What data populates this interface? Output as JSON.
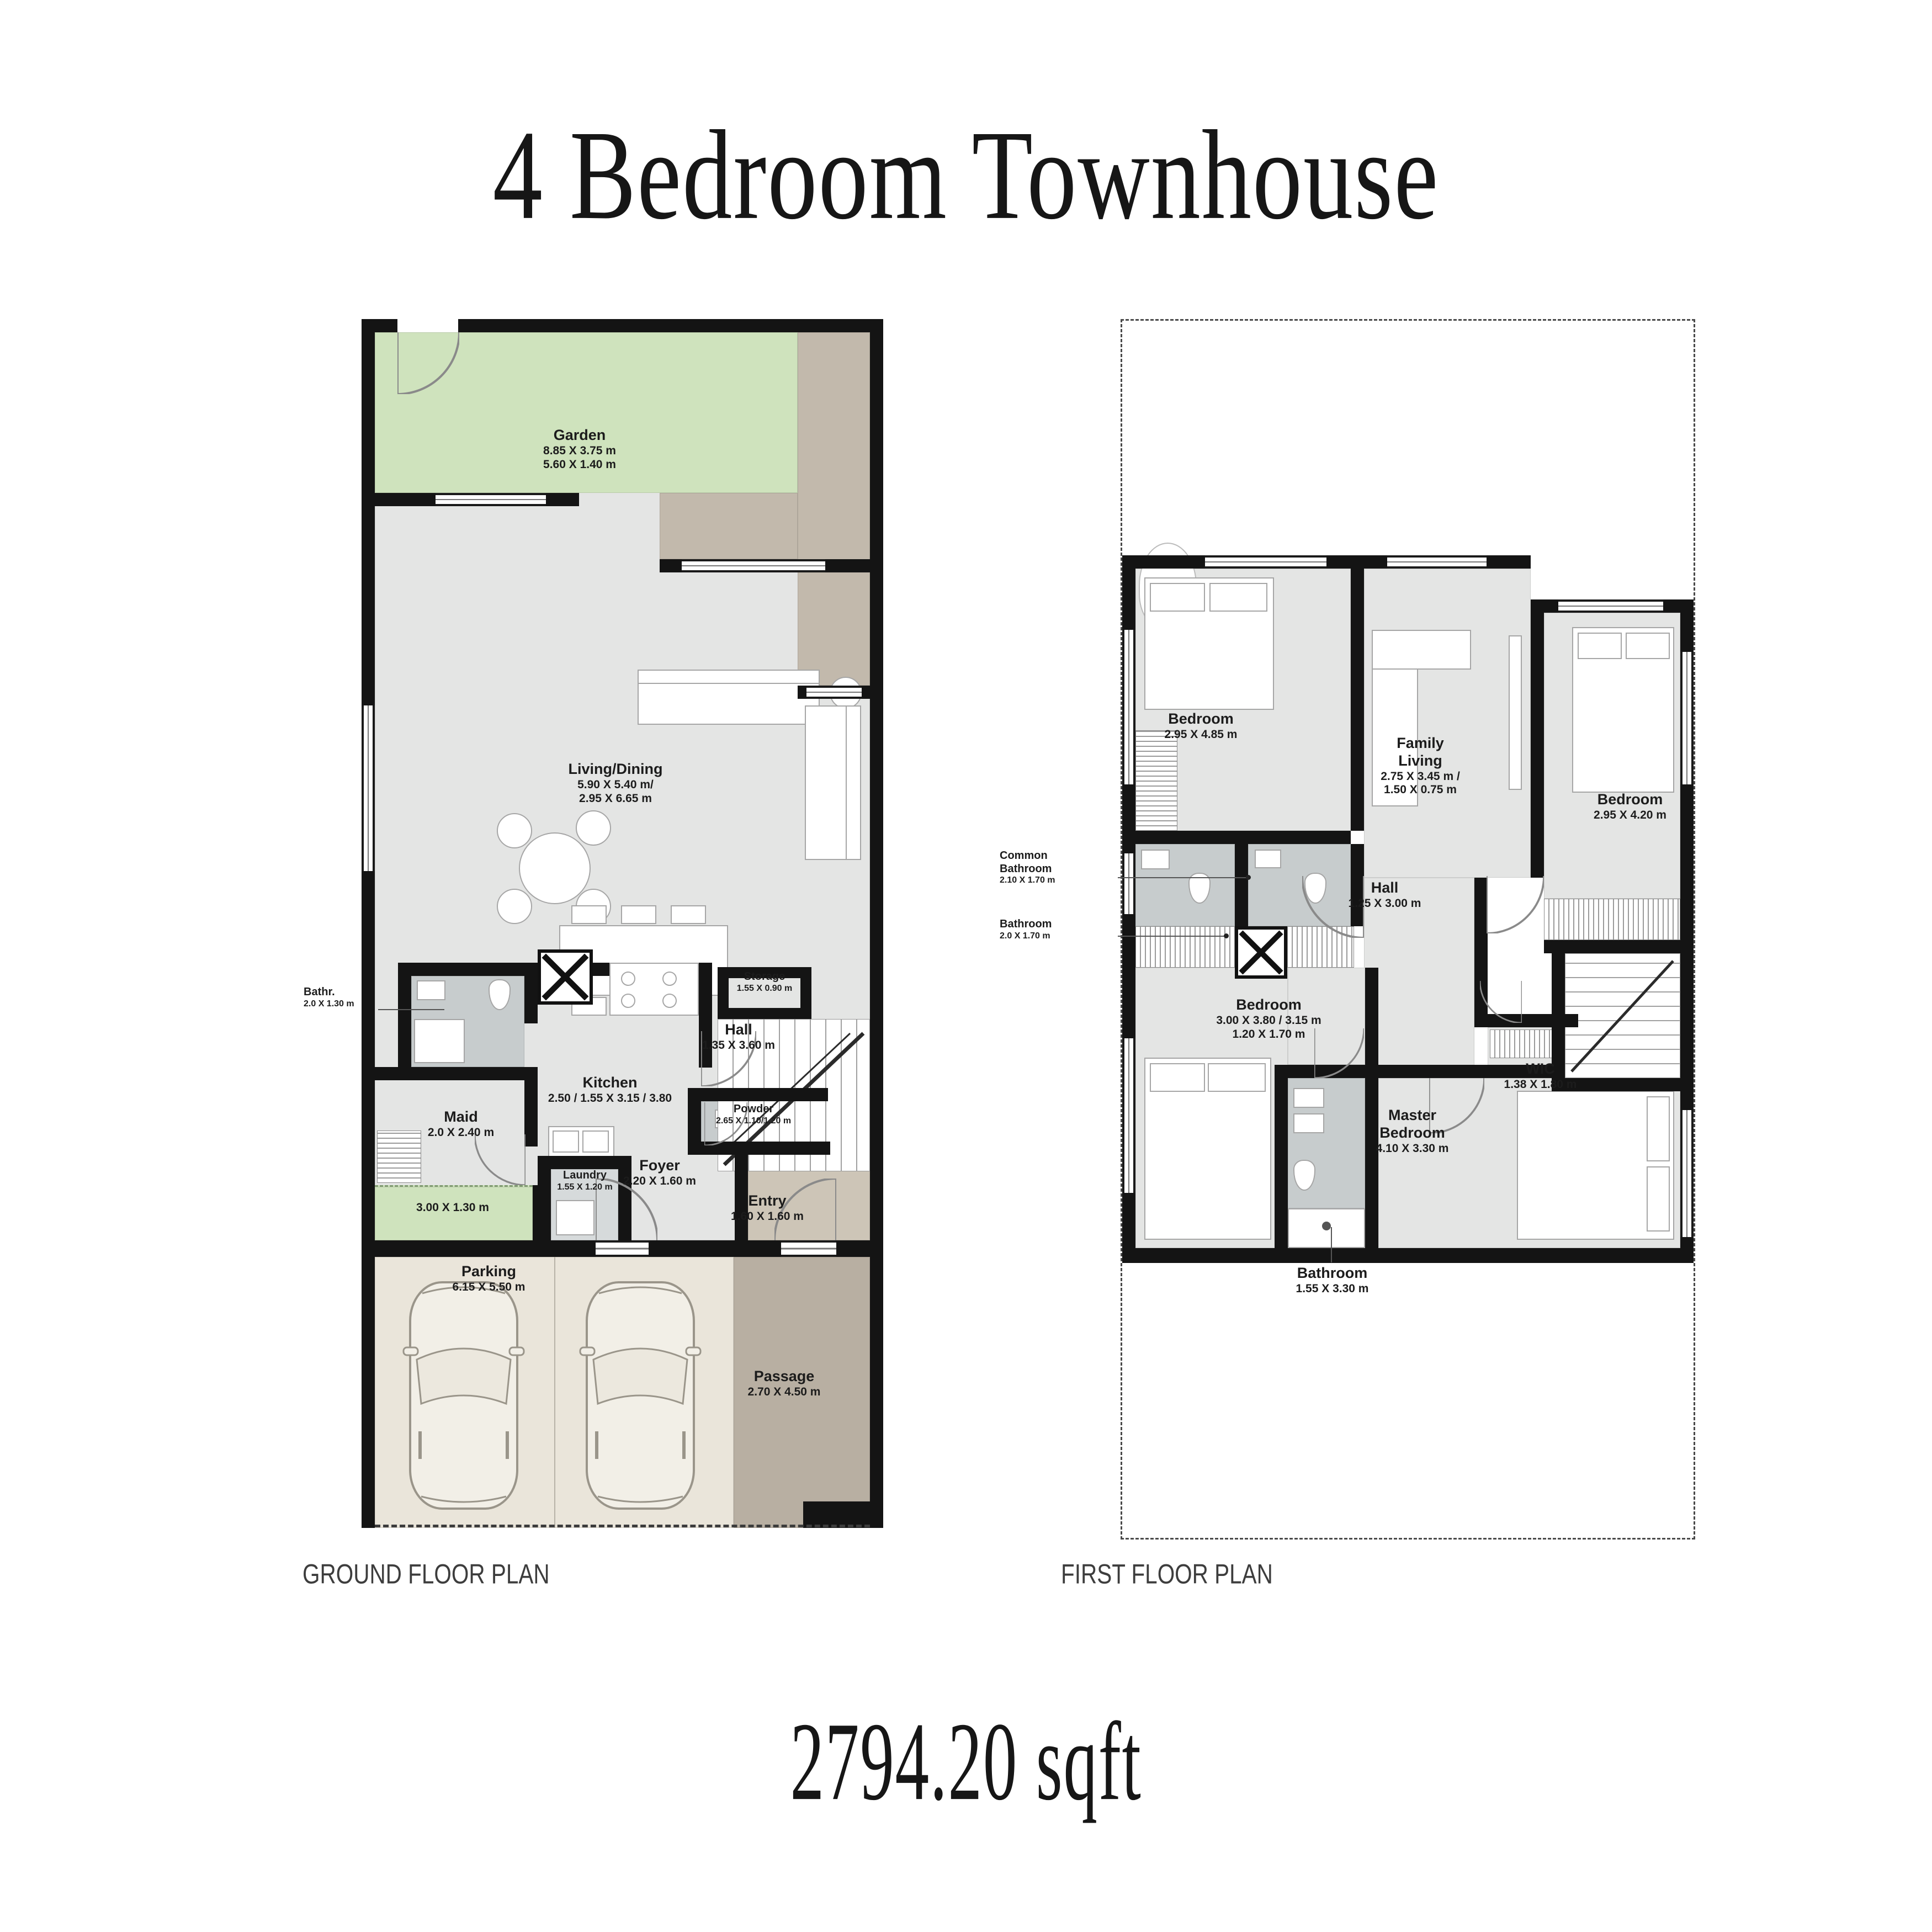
{
  "title": "4 Bedroom Townhouse",
  "area": "2794.20 sqft",
  "plans": {
    "ground": {
      "label": "GROUND FLOOR PLAN",
      "rooms": {
        "garden": {
          "name": "Garden",
          "dim1": "8.85 X 3.75 m",
          "dim2": "5.60 X 1.40 m"
        },
        "living_dining": {
          "name": "Living/Dining",
          "dim1": "5.90 X 5.40 m/",
          "dim2": "2.95 X 6.65 m"
        },
        "bathr": {
          "name": "Bathr.",
          "dim1": "2.0 X 1.30 m"
        },
        "kitchen": {
          "name": "Kitchen",
          "dim1": "2.50 / 1.55 X 3.15 / 3.80"
        },
        "hall": {
          "name": "Hall",
          "dim1": "1.35 X 3.60 m"
        },
        "maid": {
          "name": "Maid",
          "dim1": "2.0 X 2.40 m"
        },
        "storage": {
          "name": "Storage",
          "dim1": "1.55 X 0.90 m"
        },
        "powder": {
          "name": "Powder",
          "dim1": "2.65 X 1.10/1.20 m"
        },
        "foyer": {
          "name": "Foyer",
          "dim1": "2.20 X 1.60 m"
        },
        "laundry": {
          "name": "Laundry",
          "dim1": "1.55 X 1.20 m"
        },
        "entry": {
          "name": "Entry",
          "dim1": "1.60 X 1.60 m"
        },
        "parking": {
          "name": "Parking",
          "dim1": "6.15 X 5.50 m"
        },
        "passage": {
          "name": "Passage",
          "dim1": "2.70 X 4.50 m"
        },
        "side_yard": {
          "dim1": "3.00 X 1.30 m"
        }
      }
    },
    "first": {
      "label": "FIRST FLOOR PLAN",
      "rooms": {
        "bedroom_1": {
          "name": "Bedroom",
          "dim1": "2.95 X 4.85 m"
        },
        "family_living": {
          "name": "Family Living",
          "dim1": "2.75 X 3.45 m /",
          "dim2": "1.50 X 0.75 m"
        },
        "bedroom_2": {
          "name": "Bedroom",
          "dim1": "2.95 X 4.20 m"
        },
        "common_bathroom": {
          "name": "Common Bathroom",
          "dim1": "2.10 X 1.70 m"
        },
        "bathroom_1": {
          "name": "Bathroom",
          "dim1": "2.0 X 1.70 m"
        },
        "hall": {
          "name": "Hall",
          "dim1": "1.25 X 3.00 m"
        },
        "bedroom_3": {
          "name": "Bedroom",
          "dim1": "3.00 X 3.80 / 3.15 m",
          "dim2": "1.20 X 1.70 m"
        },
        "wic": {
          "name": "WIC",
          "dim1": "1.38 X 1.80 m"
        },
        "master_bedroom": {
          "name": "Master Bedroom",
          "dim1": "4.10 X 3.30 m"
        },
        "bathroom_2": {
          "name": "Bathroom",
          "dim1": "1.55 X 3.30 m"
        }
      }
    }
  },
  "colors": {
    "wall": "#141414",
    "floor": "#e4e5e4",
    "wet": "#c7cccd",
    "wet_light": "#d6dadb",
    "garden": "#cfe3bd",
    "terrace": "#c2b9ac",
    "entry": "#cdc5b7",
    "parking": "#eae5da",
    "passage": "#b8afa2",
    "line": "#999999",
    "text": "#1c1c1c"
  }
}
